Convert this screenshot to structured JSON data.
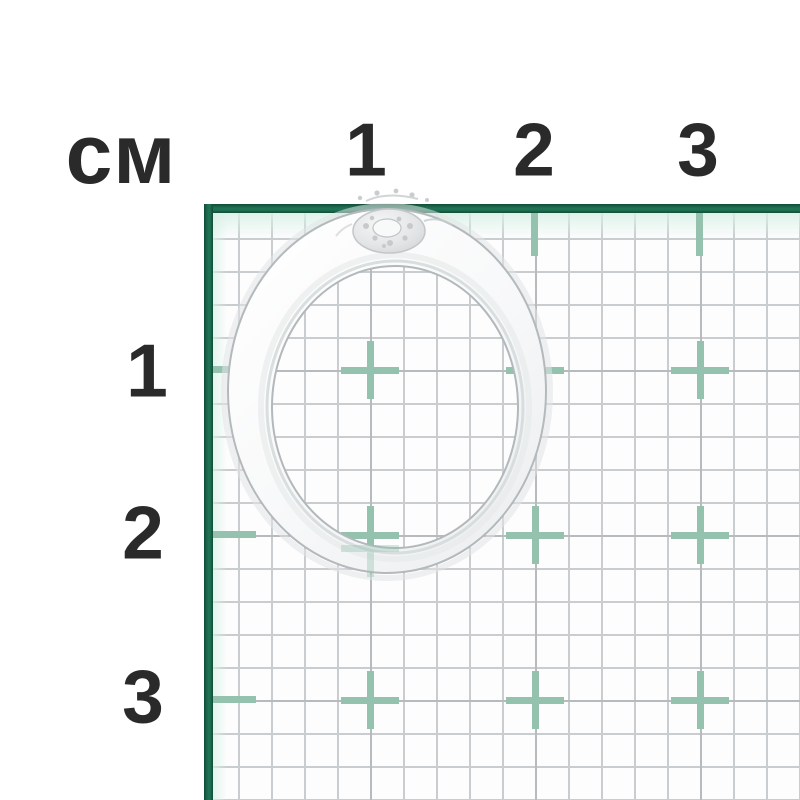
{
  "diagram": {
    "unit_label": "см",
    "top_scale": [
      "1",
      "2",
      "3"
    ],
    "left_scale": [
      "1",
      "2",
      "3"
    ],
    "subject": "silver ring with small round diamond on top of band",
    "grid": {
      "unit": "cm",
      "minor_squares_per_cm": 5,
      "visible_cm_marks_x": 3,
      "visible_cm_marks_y": 3
    },
    "colors": {
      "ruler_border_green": "#1a6b4f",
      "cross_mark_sage": "#94c2af",
      "grid_minor_line": "#c9cdd0",
      "grid_major_line": "#b7bbbe",
      "scale_text": "#2a2a2a",
      "paper": "#ffffff",
      "ring_metal": "#f4f5f6"
    }
  }
}
